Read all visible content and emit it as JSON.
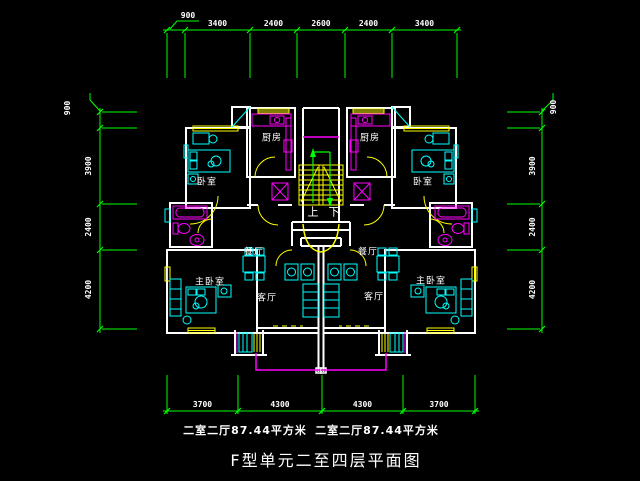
{
  "title": "F型单元二至四层平面图",
  "units": {
    "left_area_label": "二室二厅87.44平方米",
    "right_area_label": "二室二厅87.44平方米"
  },
  "rooms": {
    "bedroom": "卧室",
    "kitchen": "厨房",
    "dining": "餐厅",
    "living": "客厅",
    "master_bedroom": "主卧室",
    "stairs_up": "上",
    "stairs_down": "下"
  },
  "dimensions": {
    "top": {
      "offset": "900",
      "segments": [
        "3400",
        "2400",
        "2600",
        "2400",
        "3400"
      ]
    },
    "bottom": {
      "segments": [
        "3700",
        "4300",
        "4300",
        "3700"
      ]
    },
    "left": {
      "offset": "900",
      "segments": [
        "3900",
        "2400",
        "4200"
      ]
    },
    "right": {
      "offset": "900",
      "segments": [
        "3900",
        "2400",
        "4200"
      ]
    }
  },
  "colors": {
    "background": "#000000",
    "dimension_lines": "#00ff00",
    "walls": "#ffffff",
    "windows_doors_stairs": "#ffff00",
    "fixtures": "#ff00ff",
    "furniture": "#00ffff",
    "text": "#ffffff"
  }
}
